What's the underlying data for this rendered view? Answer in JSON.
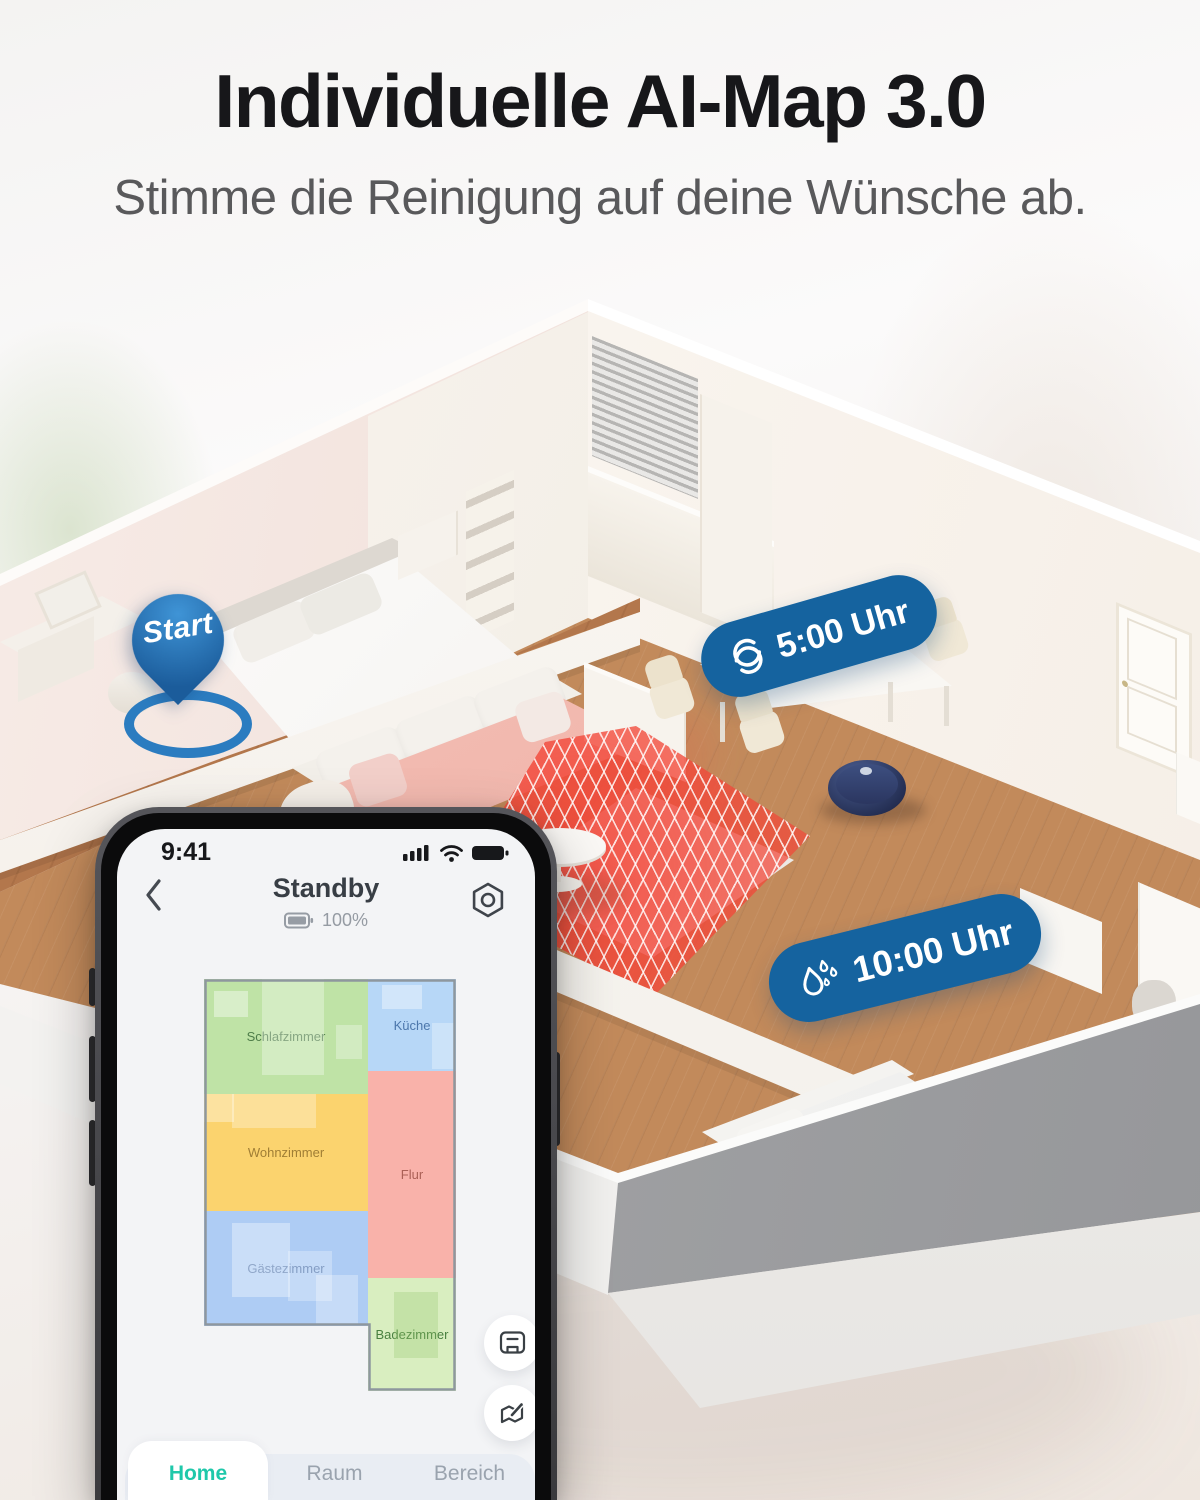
{
  "header": {
    "title": "Individuelle AI-Map 3.0",
    "subtitle": "Stimme die Reinigung auf deine Wünsche ab."
  },
  "scene": {
    "start_pin": {
      "label": "Start"
    },
    "vacuum_badge": {
      "label": "5:00 Uhr",
      "icon": "suction-swirl-icon"
    },
    "mop_badge": {
      "label": "10:00 Uhr",
      "icon": "water-drops-icon"
    },
    "colors": {
      "badge_blue": "#15639f",
      "pin_blue": "#2b7cc0",
      "no_go_zone_red": "#f0483a",
      "robot_navy": "#2a3760"
    }
  },
  "phone": {
    "status_bar": {
      "time": "9:41",
      "icons": [
        "signal-icon",
        "wifi-icon",
        "battery-icon"
      ]
    },
    "app_header": {
      "title": "Standby",
      "battery_level": "100%",
      "back_icon": "chevron-left-icon",
      "settings_icon": "gear-icon"
    },
    "map": {
      "rooms": [
        {
          "label": "Schlafzimmer",
          "color": "#bfe3a6",
          "label_color": "#4e7d49"
        },
        {
          "label": "Küche",
          "color": "#b7d7f7",
          "label_color": "#4c77ac"
        },
        {
          "label": "Wohnzimmer",
          "color": "#fbd36e",
          "label_color": "#a07e35"
        },
        {
          "label": "Flur",
          "color": "#f9b2aa",
          "label_color": "#ab6056"
        },
        {
          "label": "Gästezimmer",
          "color": "#aeccf4",
          "label_color": "#5578ad"
        },
        {
          "label": "Badezimmer",
          "color": "#d9eec0",
          "label_color": "#49803f"
        }
      ]
    },
    "fab_icons": [
      "map-manage-icon",
      "edit-map-icon"
    ],
    "tabs": [
      {
        "label": "Home",
        "active": true,
        "color": "#1fc8aa"
      },
      {
        "label": "Raum",
        "active": false
      },
      {
        "label": "Bereich",
        "active": false
      }
    ]
  }
}
